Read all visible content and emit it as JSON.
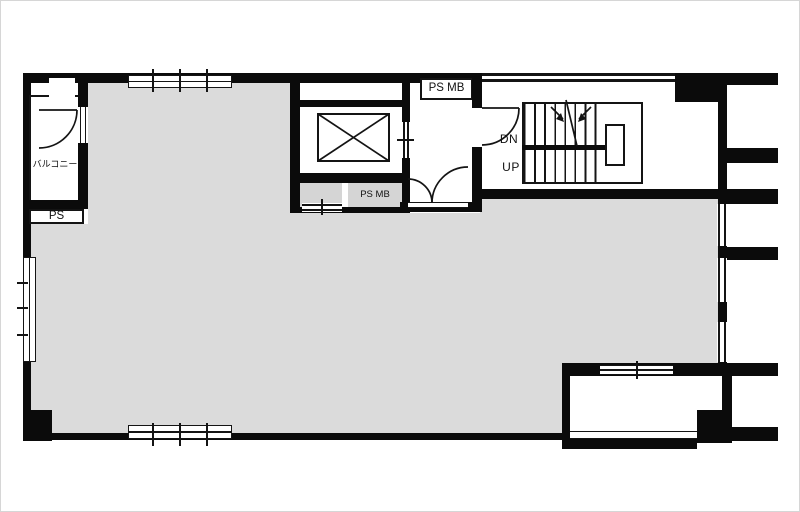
{
  "title": "floor-plan",
  "colors": {
    "wall": "#0b0b0b",
    "line": "#141414",
    "floor": "#dbdbdb",
    "cabinet": "#d5d5d5",
    "edge": "#d6d6d6"
  },
  "labels": {
    "balcony": "バルコニー",
    "ps": "PS",
    "ps_mb_hall": "PS MB",
    "ps_mb_shaft": "PS MB",
    "stairs_down": "DN",
    "stairs_up": "UP"
  }
}
